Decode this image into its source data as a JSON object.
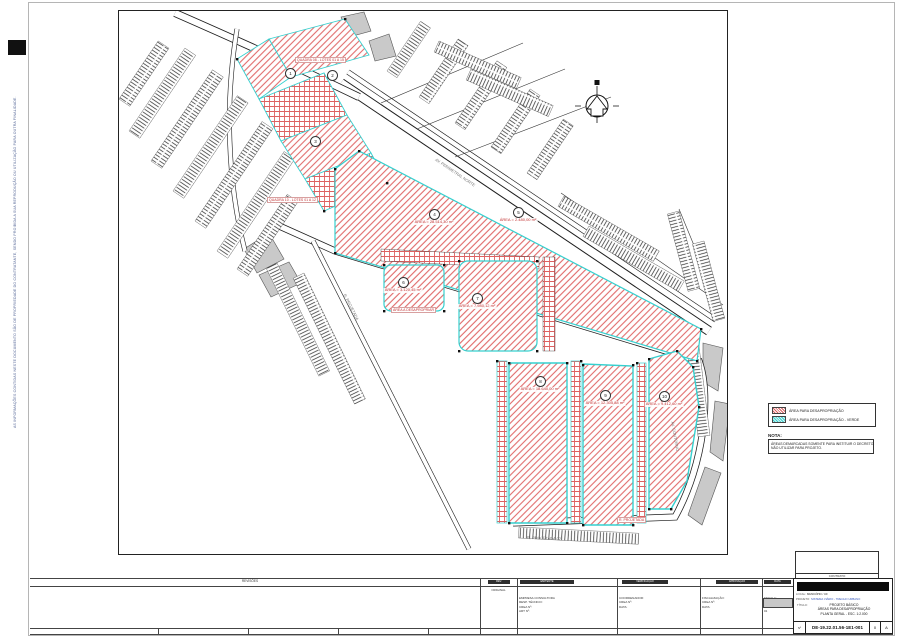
{
  "page": {
    "side_note": "AS INFORMAÇÕES CONTIDAS NESTE DOCUMENTO SÃO DE PROPRIEDADE DO CONTRATANTE, SENDO PROIBIDA A SUA REPRODUÇÃO OU UTILIZAÇÃO PARA OUTRA FINALIDADE."
  },
  "legend": {
    "items": [
      {
        "key": "red-hatch",
        "label": "ÁREA PARA DESAPROPRIAÇÃO"
      },
      {
        "key": "cyan-hatch",
        "label": "ÁREA PARA DESAPROPRIAÇÃO - VERDE"
      }
    ]
  },
  "nota": {
    "title": "NOTA:",
    "lines": [
      "ÁREAS DEMARCADAS SOMENTE PARA INSTITUIR O DECRETO.",
      "NÃO UTILIZAR PARA PROJETO."
    ]
  },
  "map": {
    "markers": [
      {
        "num": "1",
        "x": 171,
        "y": 62,
        "label": ""
      },
      {
        "num": "2",
        "x": 213,
        "y": 64,
        "label": ""
      },
      {
        "num": "3",
        "x": 196,
        "y": 130,
        "label": ""
      },
      {
        "num": "4",
        "x": 315,
        "y": 203,
        "label": "ÁREA = 28.514,30 m²"
      },
      {
        "num": "5",
        "x": 399,
        "y": 201,
        "label": "ÁREA = 2.480,00 m²"
      },
      {
        "num": "6",
        "x": 284,
        "y": 271,
        "label": "ÁREA = 3.120,45 m²"
      },
      {
        "num": "7",
        "x": 358,
        "y": 287,
        "label": "ÁREA = 7.980,12 m²"
      },
      {
        "num": "8",
        "x": 421,
        "y": 370,
        "label": "ÁREA = 18.640,00 m²"
      },
      {
        "num": "9",
        "x": 486,
        "y": 384,
        "label": "ÁREA = 12.305,88 m²"
      },
      {
        "num": "10",
        "x": 545,
        "y": 385,
        "label": "ÁREA = 9.412,60 m²"
      }
    ],
    "callouts": [
      {
        "x": 176,
        "y": 46,
        "text": "QUADRA 08 - LOTES 01 A 15"
      },
      {
        "x": 148,
        "y": 186,
        "text": "QUADRA 10 - LOTES 01 A 12"
      },
      {
        "x": 272,
        "y": 296,
        "text": "ÁREA A DESAPROPRIAR"
      },
      {
        "x": 498,
        "y": 506,
        "text": "R. PROJETADA"
      }
    ],
    "street_labels": [
      {
        "x": 318,
        "y": 146,
        "rot": 34,
        "text": "AV. PERIMETRAL NORTE"
      },
      {
        "x": 556,
        "y": 410,
        "rot": 80,
        "text": "AV. CONTORNO"
      },
      {
        "x": 228,
        "y": 282,
        "rot": 63,
        "text": "R. PROJETADA"
      },
      {
        "x": 408,
        "y": 524,
        "rot": 2,
        "text": "R. PROJETADA 02"
      }
    ],
    "north_icon": "north-arrow"
  },
  "revision_strip": {
    "header": "REVISÕES",
    "col1_header": "REV.",
    "bars": [
      "EMITENTE",
      "VERIFICAÇÃO",
      "APROVAÇÃO",
      "DATA"
    ],
    "c1_line": "ORIGINAL",
    "c2_lines": [
      "EMPRESA CONSULTORA",
      "RESP. TÉCNICO:",
      "CREA Nº:",
      "ART Nº:"
    ],
    "c3_lines": [
      "COORDENADOR:",
      "CREA Nº:",
      "DATA:"
    ],
    "c4_lines": [
      "FISCALIZAÇÃO:",
      "CREA Nº:",
      "DATA:"
    ],
    "c5_lines": [
      "ESCALA:",
      "1:2.000",
      "FOLHA:",
      "01"
    ]
  },
  "stamp_box": {
    "label": "CONTRATO"
  },
  "title_block": {
    "fields": [
      {
        "label": "LOCAL:",
        "value": "MUNICÍPIO / UF"
      },
      {
        "label": "PROJETO:",
        "value": "SISTEMA VIÁRIO - TRECHO URBANO"
      }
    ],
    "titulo_label": "TÍTULO:",
    "title_lines": [
      "PROJETO BÁSICO",
      "ÁREAS PARA DESAPROPRIAÇÃO",
      "PLANTA GERAL - ESC. 1:2.000"
    ],
    "number_label": "Nº",
    "drawing_number": "DE-19.22.01.56-1E1-001",
    "rev_cells": [
      "0",
      "A"
    ]
  },
  "colors": {
    "hatch_red": "#e06a6a",
    "grid_red": "#dd6161",
    "boundary_cyan": "#35d0cf",
    "parcel_grey": "#c9c9c9"
  }
}
